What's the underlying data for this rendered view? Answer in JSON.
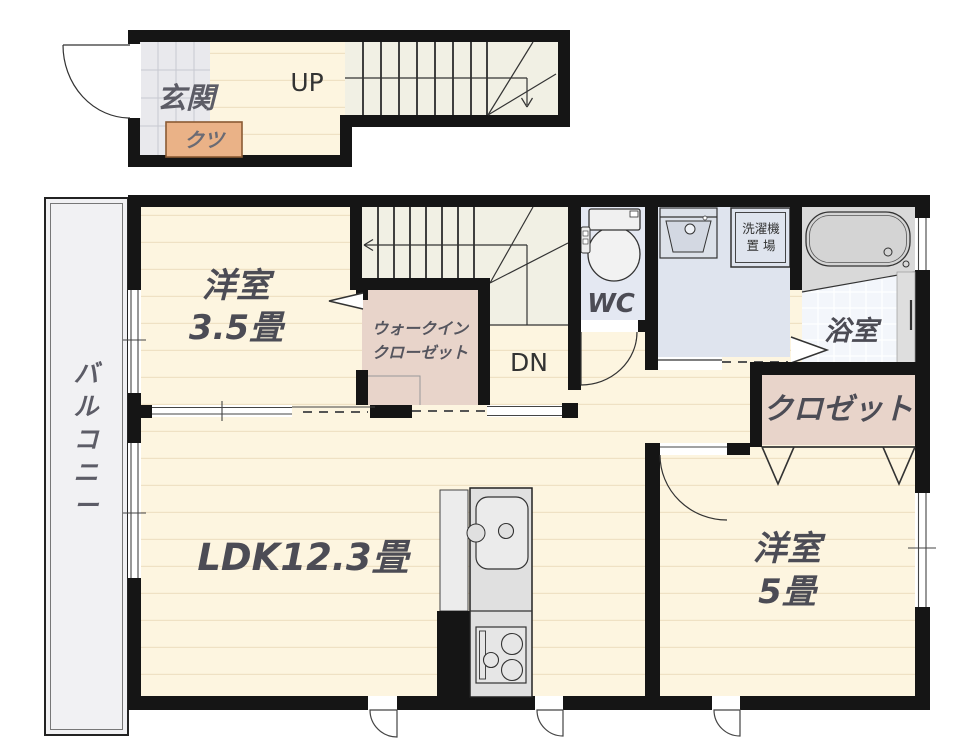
{
  "plan": {
    "upper_section": {
      "entrance_label": "玄関",
      "shoes_label": "クツ",
      "stairs_up_label": "UP"
    },
    "main_section": {
      "balcony_label": "バルコニー",
      "balcony_chars": [
        "バ",
        "ル",
        "コ",
        "ニ",
        "ー"
      ],
      "room1_label": "洋室",
      "room1_size": "3.5畳",
      "wic_label_line1": "ウォークイン",
      "wic_label_line2": "クローゼット",
      "stairs_down_label": "DN",
      "wc_label": "WC",
      "laundry_label_line1": "洗濯機",
      "laundry_label_line2": "置 場",
      "bath_label": "浴室",
      "closet_label": "クロゼット",
      "ldk_label": "LDK12.3畳",
      "room2_label": "洋室",
      "room2_size": "5畳"
    },
    "colors": {
      "wall": "#151515",
      "cream": "#fdf5e0",
      "plank": "#efe1c4",
      "tile": "#e9e9ed",
      "stair": "#f1f0e4",
      "water": "#dfe4ee",
      "wc": "#e4e8f2",
      "pink": "#e8d4ca",
      "shoe": "#eab287",
      "balcony": "#f1f1f3",
      "bathgray": "#d9d9d9",
      "bathtile": "#f3f6fb",
      "label": "#4c4c55"
    }
  }
}
